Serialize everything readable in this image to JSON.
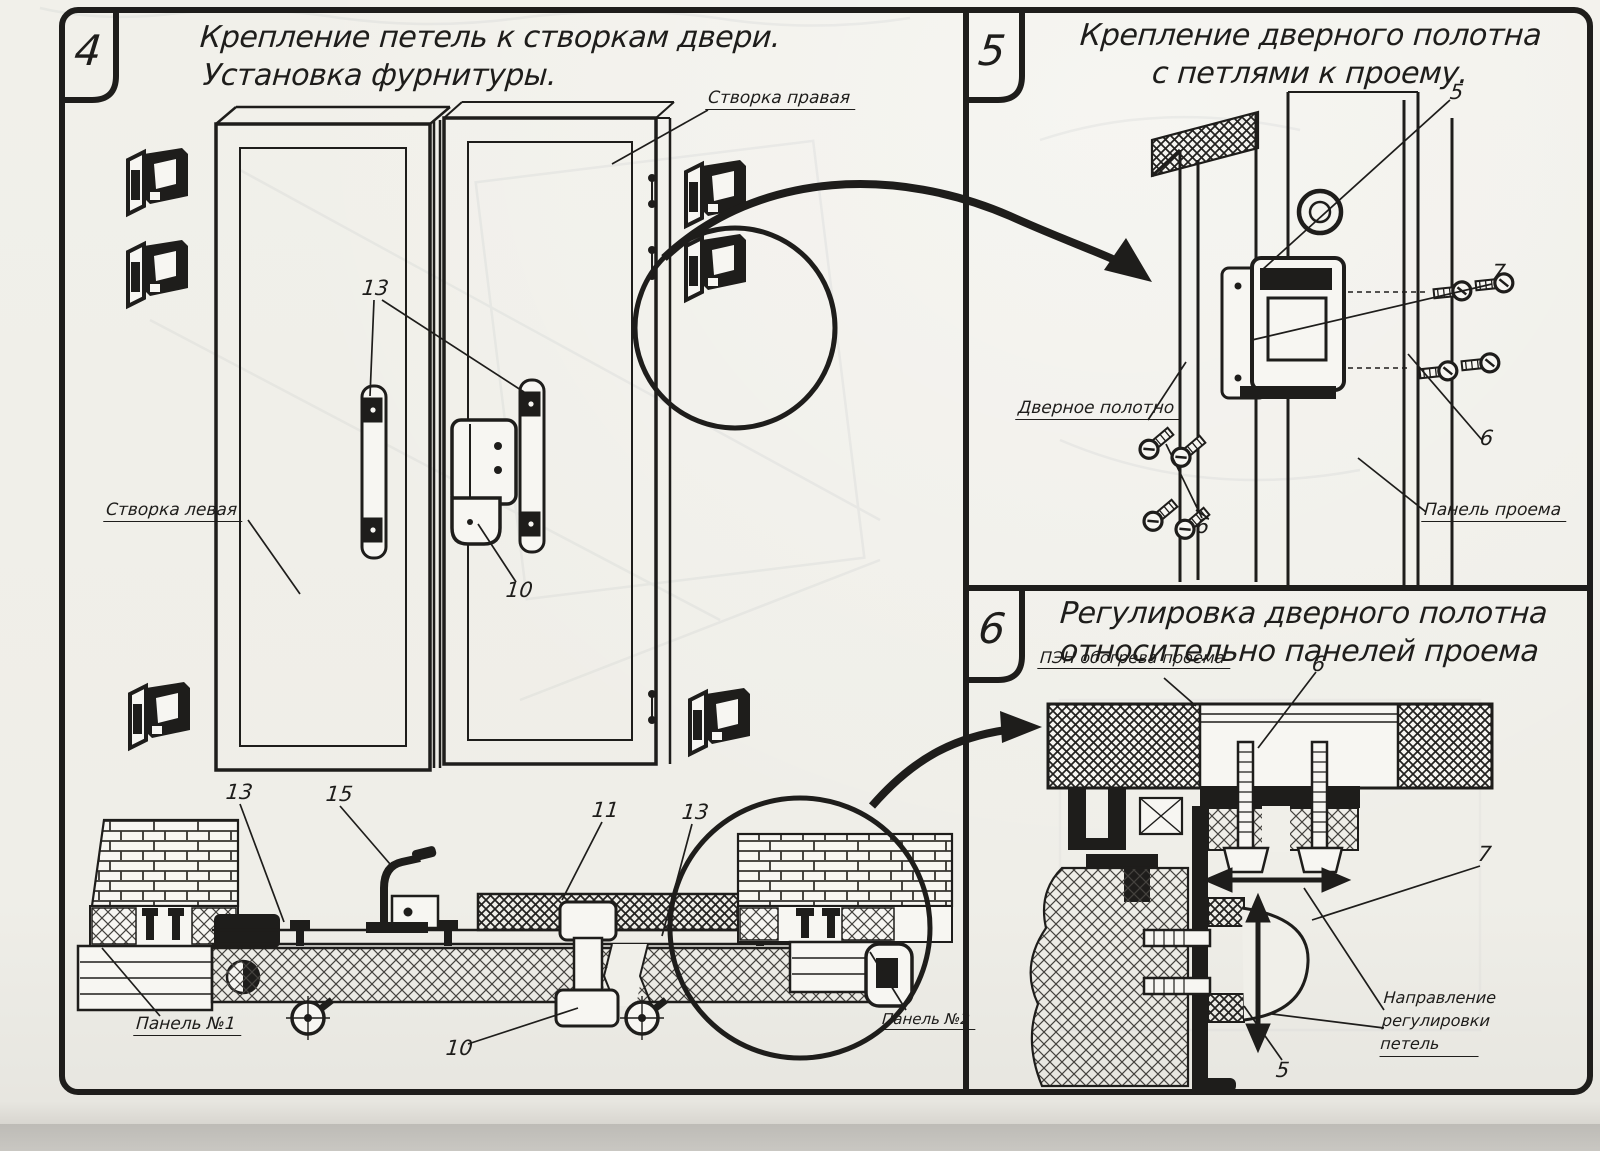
{
  "colors": {
    "paper": "#f0efe9",
    "ink": "#1e1d1b",
    "scan_backdrop": "#c7c5c0"
  },
  "panels": [
    {
      "number": "4",
      "title_line1": "Крепление петель к створкам двери.",
      "title_line2": "Установка фурнитуры.",
      "labels": {
        "right_leaf": "Створка правая",
        "left_leaf": "Створка левая",
        "panel_no1": "Панель №1",
        "panel_no2": "Панель №2"
      },
      "callouts": {
        "hinge_plates": "13",
        "door_lock": "10",
        "section_left_profile": "13",
        "hook": "15",
        "bottom_latch": "11",
        "section_right_profile": "13",
        "bottom_lock": "10"
      }
    },
    {
      "number": "5",
      "title_line1": "Крепление дверного полотна",
      "title_line2": "с петлями к проему.",
      "labels": {
        "door_leaf": "Дверное полотно",
        "opening_panel": "Панель проема"
      },
      "callouts": {
        "hinge": "5",
        "hinge_bracket": "7",
        "screws_right": "6",
        "screws_left": "6"
      }
    },
    {
      "number": "6",
      "title_line1": "Регулировка дверного полотна",
      "title_line2": "относительно панелей проема",
      "labels": {
        "heater": "ПЭН обогрева проема",
        "adjustment_direction_line1": "Направление регулировки",
        "adjustment_direction_line2": "петель"
      },
      "callouts": {
        "adjusting_bolts": "6",
        "hinge_body": "7",
        "hinge_plate": "5"
      }
    }
  ]
}
